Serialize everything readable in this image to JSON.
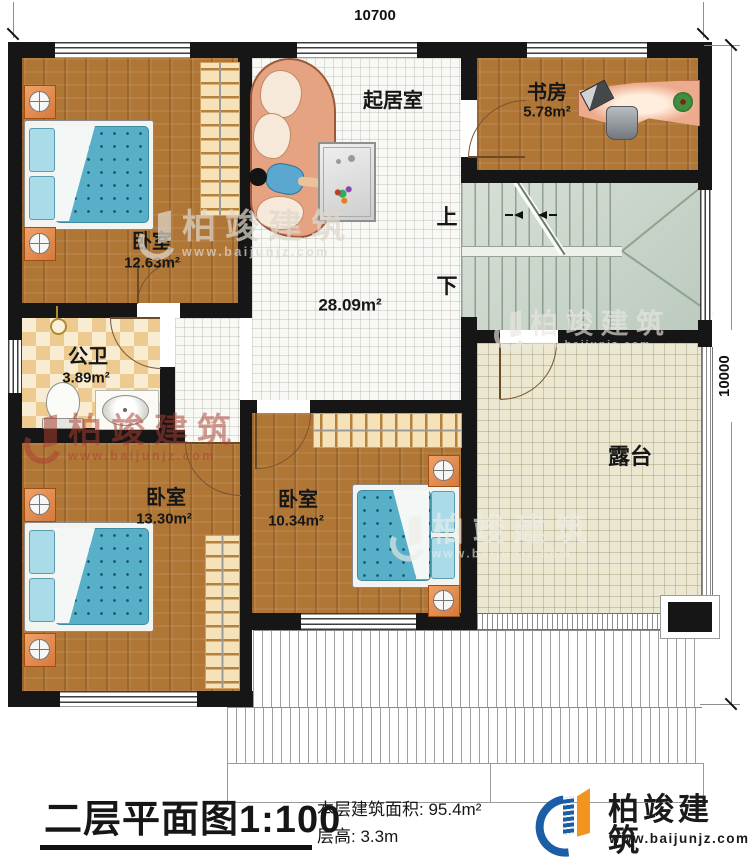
{
  "plan": {
    "dim_top": "10700",
    "dim_right": "10000",
    "rooms": {
      "living": {
        "name": "起居室",
        "area": "28.09m²"
      },
      "study": {
        "name": "书房",
        "area": "5.78m²"
      },
      "bedroom1": {
        "name": "卧室",
        "area": "12.63m²"
      },
      "bathroom": {
        "name": "公卫",
        "area": "3.89m²"
      },
      "bedroom2": {
        "name": "卧室",
        "area": "13.30m²"
      },
      "bedroom3": {
        "name": "卧室",
        "area": "10.34m²"
      },
      "terrace": {
        "name": "露台"
      }
    },
    "stairs": {
      "up_label": "上",
      "down_label": "下"
    }
  },
  "titleblock": {
    "title": "二层平面图",
    "scale": "1:100",
    "area_line": "本层建筑面积: 95.4m²",
    "height_line": "层高: 3.3m"
  },
  "brand": {
    "name": "柏竣建筑",
    "url": "www.baijunjz.com"
  },
  "watermark": {
    "name": "柏竣建筑",
    "url": "www.baijunjz.com"
  },
  "colors": {
    "wall": "#161616",
    "wood": "#b07636",
    "tile": "#f8f8f5",
    "terrace": "#ebe7d1",
    "stairs": "#ccd6cb",
    "brand_blue": "#1b5ea6",
    "brand_orange": "#f2951f"
  }
}
